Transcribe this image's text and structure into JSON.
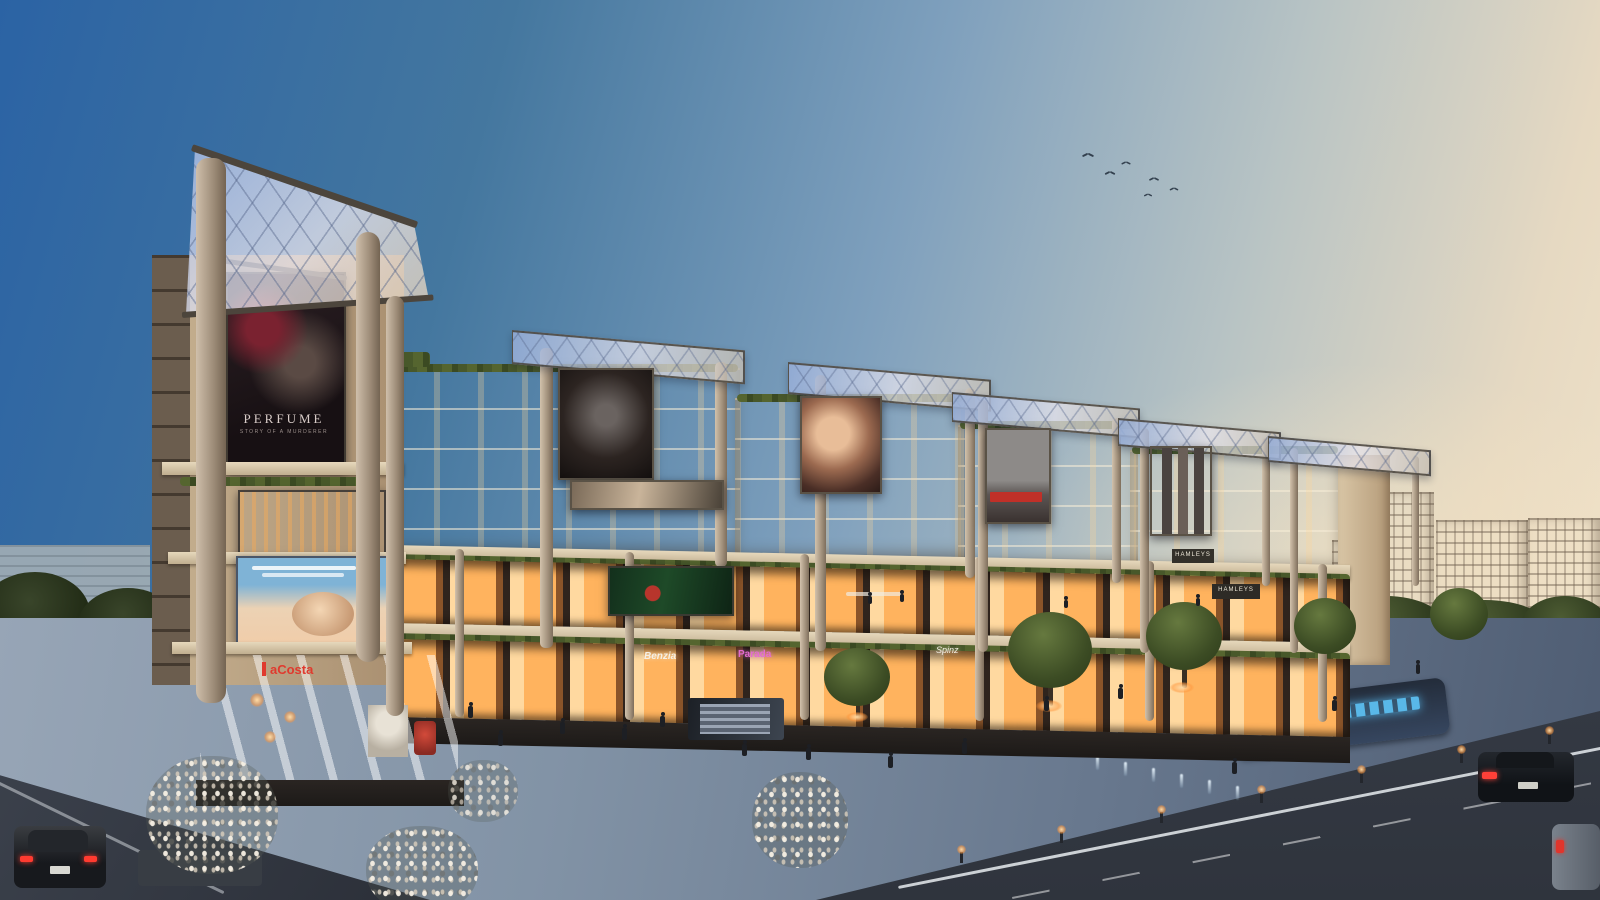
{
  "scene": {
    "description": "Dusk architectural rendering of a multi-level high-street retail mall with rooftop glass pergolas, illuminated storefronts, plaza, trees and road"
  },
  "billboards": {
    "perfume": {
      "title": "PERFUME",
      "subtitle": "STORY OF A MURDERER"
    }
  },
  "storefronts": {
    "acosta": {
      "label": "aCosta",
      "color": "#e03a2e"
    },
    "benzia": {
      "label": "Benzia",
      "color": "#f5f0e6"
    },
    "parada": {
      "label": "Parada",
      "color": "#e36bd0"
    },
    "spinz": {
      "label": "Spinz",
      "color": "#f2ede2"
    },
    "hamleys_upper": {
      "label": "HAMLEYS",
      "color": "#efe9da"
    },
    "hamleys_lower": {
      "label": "HAMLEYS",
      "color": "#efe9da"
    }
  },
  "palette": {
    "sky_top": "#2b63a4",
    "sky_horizon": "#f2e4ca",
    "canopy_glass": "#aabede",
    "facade_tan": "#c0a988",
    "storefront_glow": "#ffb866",
    "hedge_green": "#46522c",
    "plaza": "#8493a6",
    "road": "#3a414e",
    "water_letter_blue": "#55b5e8"
  }
}
